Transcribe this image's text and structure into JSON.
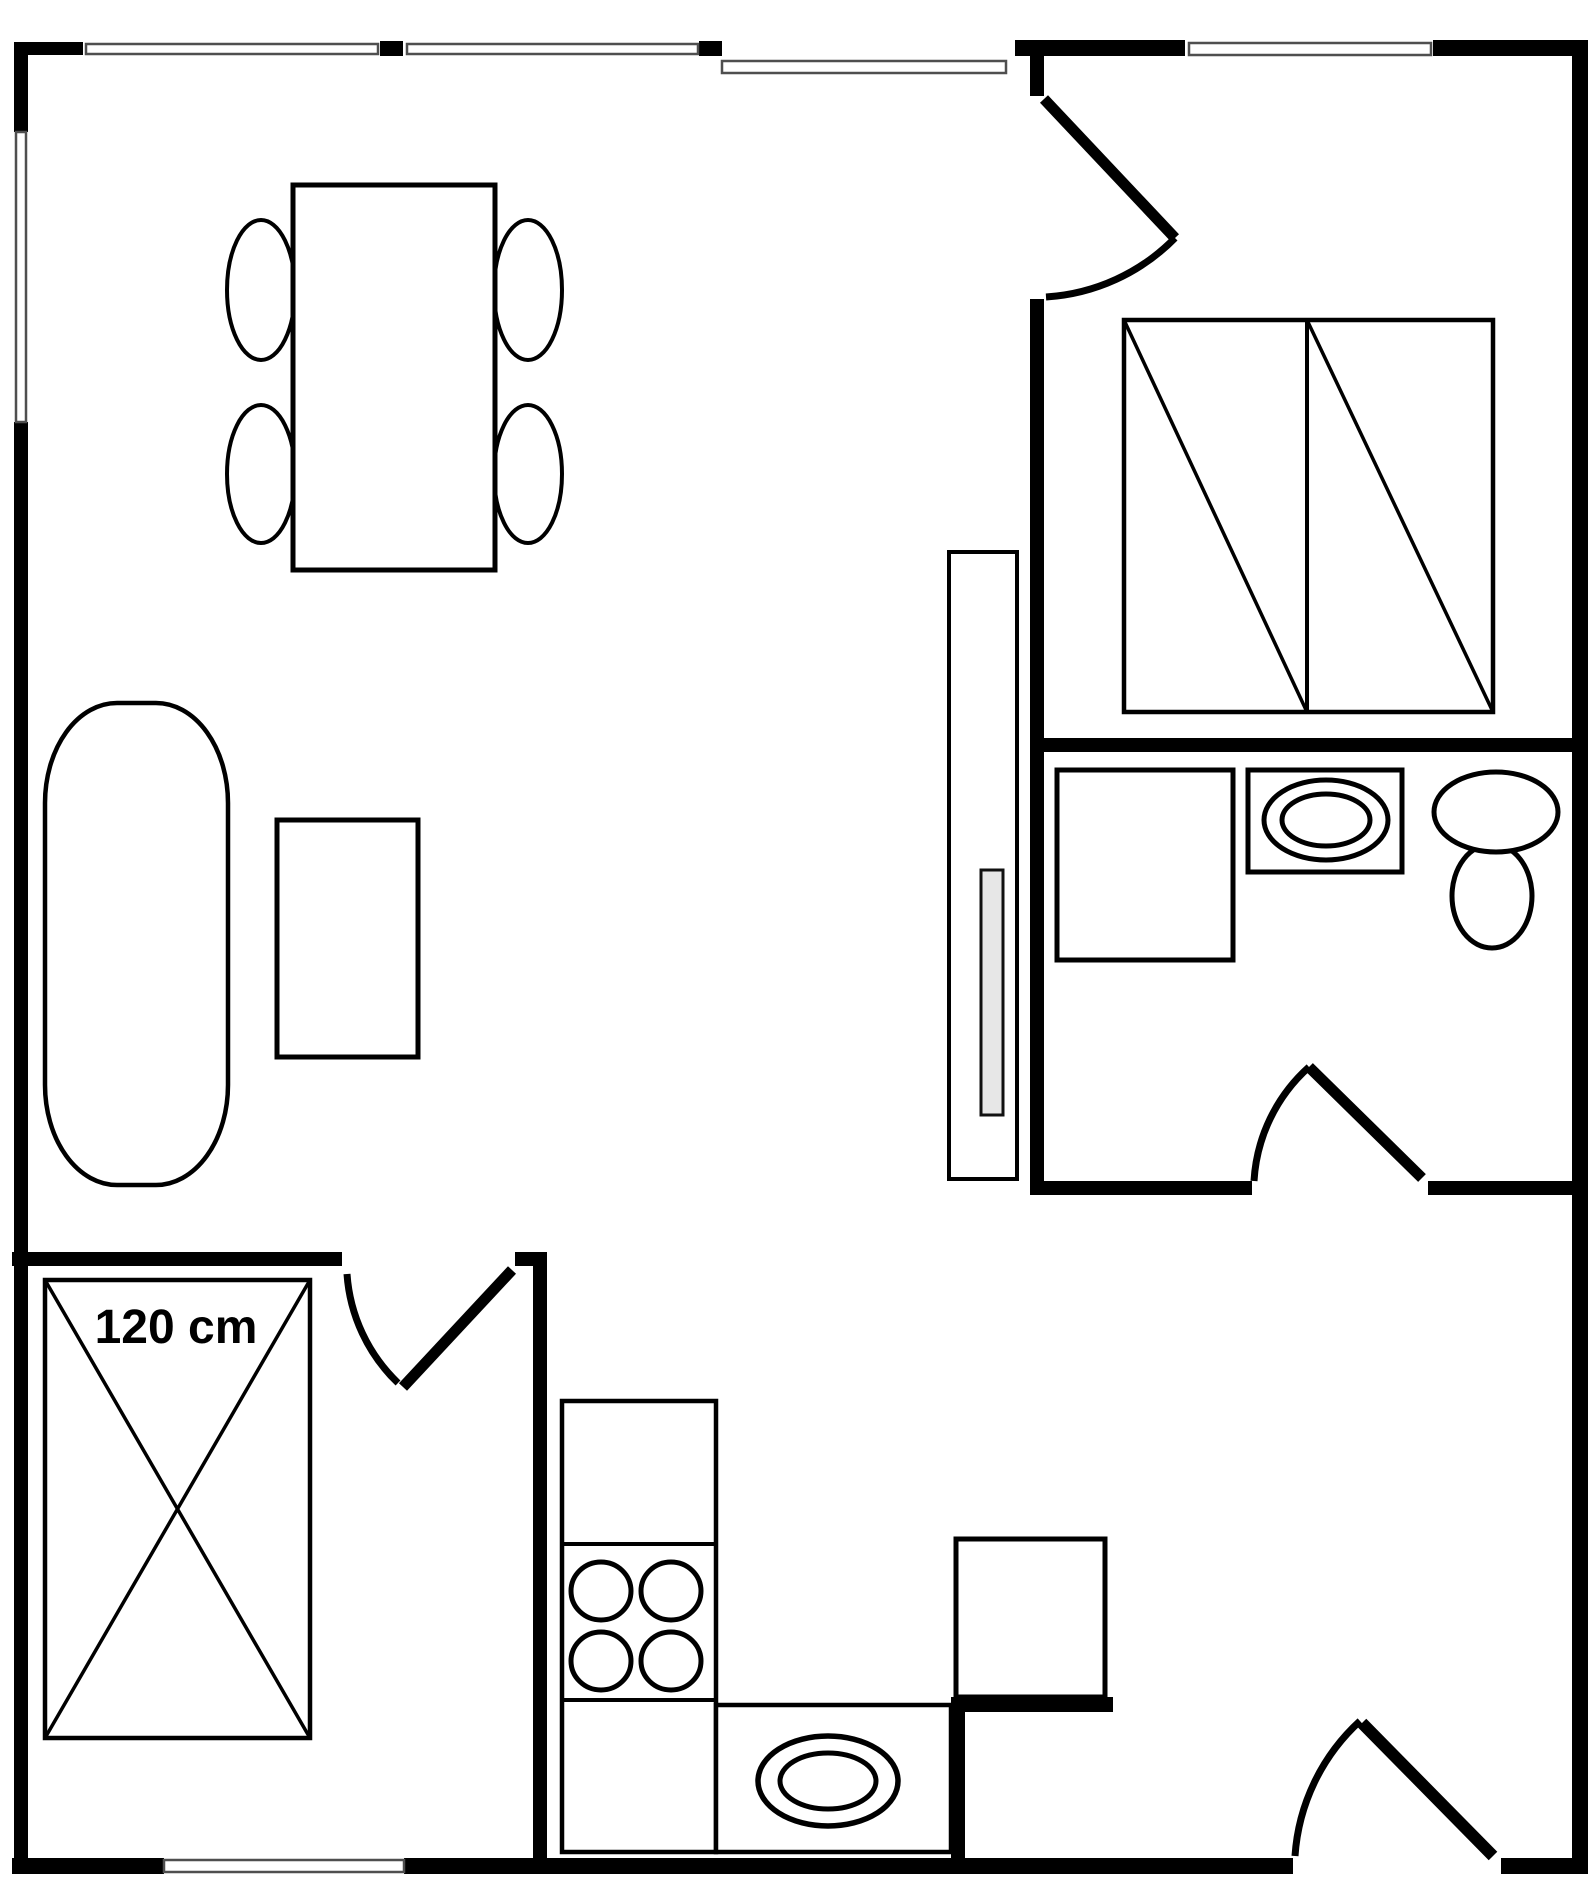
{
  "canvas": {
    "width": 1590,
    "height": 1889
  },
  "colors": {
    "wall": "#000000",
    "background": "#ffffff",
    "furniture_outline": "#000000",
    "window_outline": "#4f4f4f",
    "window_fill": "#ffffff",
    "cabinet_handle_fill": "#e7e7e7"
  },
  "annotation": {
    "bed_width_label": "120 cm"
  },
  "items": [
    "dining-table",
    "dining-chair",
    "sofa",
    "coffee-table",
    "wardrobe",
    "double-bed",
    "shower",
    "bathroom-sink",
    "toilet",
    "kitchen-counter",
    "stove-burner",
    "kitchen-sink",
    "kitchen-appliance",
    "single-bed-120cm",
    "door",
    "window",
    "wall"
  ]
}
